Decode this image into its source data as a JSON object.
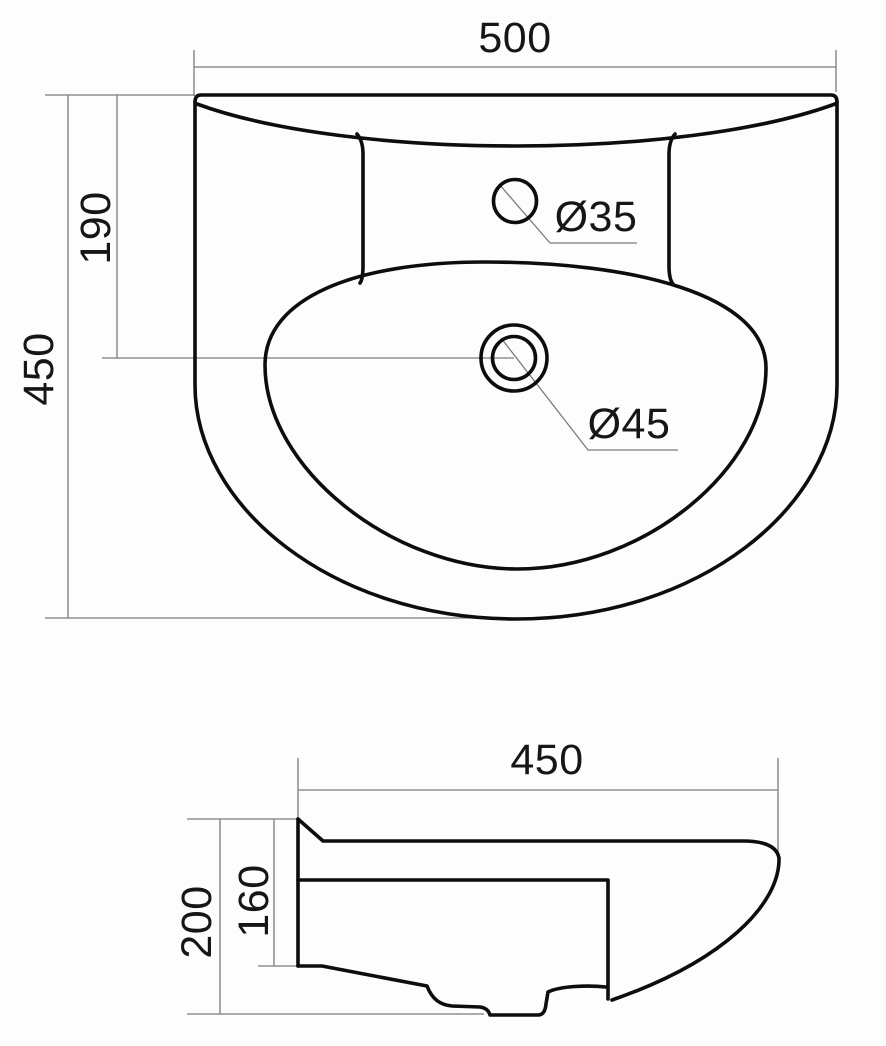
{
  "drawing": {
    "top_view": {
      "width_label": "500",
      "height_label": "450",
      "drain_offset_label": "190",
      "faucet_hole_label": "Ø35",
      "drain_hole_label": "Ø45"
    },
    "side_view": {
      "depth_label": "450",
      "height_label": "200",
      "inner_height_label": "160"
    },
    "colors": {
      "outline": "#0d0d0d",
      "dimension_line": "#7b7b7b",
      "text": "#161616",
      "background": "#fdfdfd"
    }
  }
}
